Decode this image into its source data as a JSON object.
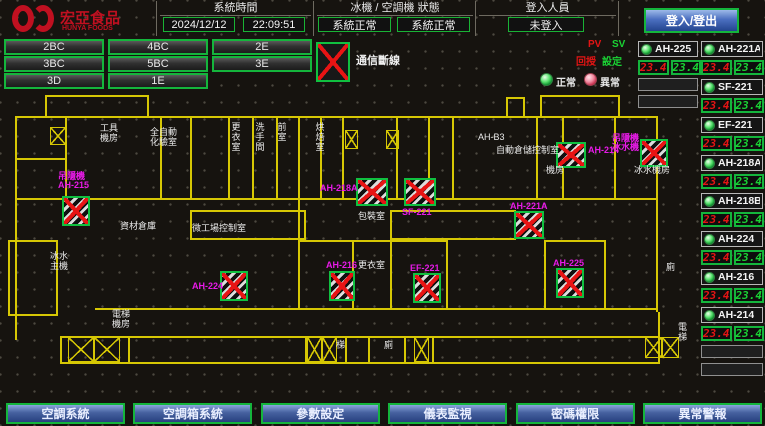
{
  "header": {
    "logo_text": "宏亞食品",
    "logo_subtext": "HUNYA FOODS",
    "time_label": "系統時間",
    "date": "2024/12/12",
    "clock": "22:09:51",
    "status_label": "冰機 / 空調機 狀態",
    "chiller_status": "系統正常",
    "ahu_status": "系統正常",
    "login_label": "登入人員",
    "login_value": "未登入",
    "login_button": "登入/登出"
  },
  "floor_nav": {
    "rows": [
      [
        "2BC",
        "4BC",
        "2E"
      ],
      [
        "3BC",
        "5BC",
        "3E"
      ],
      [
        "3D",
        "1E"
      ]
    ]
  },
  "legend": {
    "comm_loss": "通信斷線",
    "pv": "PV",
    "sv": "SV",
    "pv_sub": "回授",
    "sv_sub": "設定",
    "normal": "正常",
    "abnormal": "異常"
  },
  "units_panel": {
    "left_column": [
      {
        "name": "AH-225",
        "pv": "23.4",
        "sv": "23.4"
      }
    ],
    "right_column": [
      {
        "name": "AH-221A",
        "pv": "23.4",
        "sv": "23.4"
      },
      {
        "name": "SF-221",
        "pv": "23.4",
        "sv": "23.4"
      },
      {
        "name": "EF-221",
        "pv": "23.4",
        "sv": "23.4"
      },
      {
        "name": "AH-218A",
        "pv": "23.4",
        "sv": "23.4"
      },
      {
        "name": "AH-218B",
        "pv": "23.4",
        "sv": "23.4"
      },
      {
        "name": "AH-224",
        "pv": "23.4",
        "sv": "23.4"
      },
      {
        "name": "AH-216",
        "pv": "23.4",
        "sv": "23.4"
      },
      {
        "name": "AH-214",
        "pv": "23.4",
        "sv": "23.4"
      }
    ]
  },
  "map": {
    "walls": [
      [
        15,
        116,
        643,
        2
      ],
      [
        45,
        95,
        104,
        2
      ],
      [
        45,
        95,
        2,
        23
      ],
      [
        147,
        95,
        2,
        23
      ],
      [
        540,
        95,
        80,
        2
      ],
      [
        540,
        95,
        2,
        23
      ],
      [
        618,
        95,
        2,
        23
      ],
      [
        506,
        97,
        19,
        2
      ],
      [
        506,
        97,
        2,
        21
      ],
      [
        523,
        97,
        2,
        21
      ],
      [
        15,
        116,
        2,
        224
      ],
      [
        65,
        116,
        2,
        84
      ],
      [
        15,
        158,
        52,
        2
      ],
      [
        160,
        116,
        2,
        84
      ],
      [
        190,
        116,
        2,
        84
      ],
      [
        228,
        116,
        2,
        84
      ],
      [
        252,
        116,
        2,
        84
      ],
      [
        276,
        116,
        2,
        84
      ],
      [
        298,
        116,
        2,
        84
      ],
      [
        320,
        116,
        2,
        84
      ],
      [
        342,
        116,
        2,
        84
      ],
      [
        396,
        116,
        2,
        84
      ],
      [
        428,
        116,
        2,
        84
      ],
      [
        452,
        116,
        2,
        84
      ],
      [
        536,
        116,
        2,
        84
      ],
      [
        562,
        116,
        2,
        84
      ],
      [
        614,
        116,
        2,
        84
      ],
      [
        656,
        116,
        2,
        196
      ],
      [
        15,
        198,
        643,
        2
      ],
      [
        190,
        210,
        116,
        2
      ],
      [
        190,
        238,
        116,
        2
      ],
      [
        190,
        210,
        2,
        30
      ],
      [
        304,
        210,
        2,
        30
      ],
      [
        390,
        210,
        126,
        2
      ],
      [
        390,
        238,
        126,
        2
      ],
      [
        390,
        210,
        2,
        30
      ],
      [
        514,
        210,
        2,
        30
      ],
      [
        8,
        240,
        50,
        2
      ],
      [
        8,
        314,
        50,
        2
      ],
      [
        8,
        240,
        2,
        76
      ],
      [
        56,
        240,
        2,
        76
      ],
      [
        298,
        198,
        2,
        112
      ],
      [
        298,
        240,
        150,
        2
      ],
      [
        352,
        240,
        2,
        68
      ],
      [
        390,
        240,
        2,
        68
      ],
      [
        446,
        240,
        2,
        68
      ],
      [
        544,
        240,
        62,
        2
      ],
      [
        544,
        240,
        2,
        68
      ],
      [
        604,
        240,
        2,
        68
      ],
      [
        95,
        308,
        563,
        2
      ],
      [
        60,
        336,
        600,
        2
      ],
      [
        60,
        362,
        600,
        2
      ],
      [
        60,
        336,
        2,
        28
      ],
      [
        128,
        336,
        2,
        28
      ],
      [
        305,
        336,
        2,
        28
      ],
      [
        345,
        336,
        2,
        28
      ],
      [
        368,
        336,
        2,
        28
      ],
      [
        404,
        336,
        2,
        28
      ],
      [
        432,
        336,
        2,
        28
      ],
      [
        658,
        312,
        2,
        52
      ]
    ],
    "stairs": [
      [
        50,
        127,
        16,
        18
      ],
      [
        345,
        130,
        13,
        19
      ],
      [
        386,
        130,
        13,
        19
      ],
      [
        68,
        337,
        26,
        25
      ],
      [
        94,
        337,
        26,
        25
      ],
      [
        307,
        337,
        15,
        25
      ],
      [
        322,
        337,
        15,
        25
      ],
      [
        414,
        337,
        15,
        25
      ],
      [
        645,
        337,
        17,
        21
      ],
      [
        662,
        337,
        17,
        21
      ]
    ],
    "units": [
      {
        "x": 62,
        "y": 196,
        "w": 28,
        "h": 30,
        "label": "吊隱機\nAH-215",
        "lx": 58,
        "ly": 172
      },
      {
        "x": 356,
        "y": 178,
        "w": 32,
        "h": 28,
        "label": "AH-218A",
        "lx": 320,
        "ly": 184
      },
      {
        "x": 404,
        "y": 178,
        "w": 32,
        "h": 28,
        "label": "SF-221",
        "lx": 402,
        "ly": 208
      },
      {
        "x": 556,
        "y": 142,
        "w": 30,
        "h": 26,
        "label": "AH-214",
        "lx": 588,
        "ly": 146
      },
      {
        "x": 640,
        "y": 139,
        "w": 28,
        "h": 28,
        "label": "吊隱機\n冰水機",
        "lx": 612,
        "ly": 134
      },
      {
        "x": 514,
        "y": 211,
        "w": 30,
        "h": 28,
        "label": "AH-221A",
        "lx": 510,
        "ly": 202
      },
      {
        "x": 220,
        "y": 271,
        "w": 28,
        "h": 30,
        "label": "AH-224",
        "lx": 192,
        "ly": 282
      },
      {
        "x": 329,
        "y": 271,
        "w": 26,
        "h": 30,
        "label": "AH-216",
        "lx": 326,
        "ly": 261
      },
      {
        "x": 413,
        "y": 273,
        "w": 28,
        "h": 30,
        "label": "EF-221",
        "lx": 410,
        "ly": 264
      },
      {
        "x": 556,
        "y": 268,
        "w": 28,
        "h": 30,
        "label": "AH-225",
        "lx": 553,
        "ly": 259
      }
    ],
    "labels": [
      {
        "x": 100,
        "y": 124,
        "text": "工具\n機房"
      },
      {
        "x": 150,
        "y": 128,
        "text": "全自動\n化驗室"
      },
      {
        "x": 120,
        "y": 222,
        "text": "資材倉庫"
      },
      {
        "x": 192,
        "y": 224,
        "text": "微工場控制室"
      },
      {
        "x": 50,
        "y": 252,
        "text": "冰水\n主機"
      },
      {
        "x": 496,
        "y": 146,
        "text": "自動倉儲控制室"
      },
      {
        "x": 478,
        "y": 133,
        "text": "AH-B3"
      },
      {
        "x": 358,
        "y": 261,
        "text": "更衣室"
      },
      {
        "x": 358,
        "y": 212,
        "text": "包裝室"
      },
      {
        "x": 112,
        "y": 310,
        "text": "電梯\n機房"
      },
      {
        "x": 336,
        "y": 341,
        "text": "梯"
      },
      {
        "x": 384,
        "y": 341,
        "text": "廁"
      },
      {
        "x": 666,
        "y": 263,
        "text": "廁"
      },
      {
        "x": 678,
        "y": 323,
        "text": "電\n梯"
      },
      {
        "x": 546,
        "y": 166,
        "text": "機房"
      },
      {
        "x": 634,
        "y": 166,
        "text": "冰水機房"
      },
      {
        "x": 230,
        "y": 122,
        "text": "更衣室",
        "vert": true
      },
      {
        "x": 254,
        "y": 122,
        "text": "洗手間",
        "vert": true
      },
      {
        "x": 276,
        "y": 122,
        "text": "前室",
        "vert": true
      },
      {
        "x": 314,
        "y": 122,
        "text": "烘焙室",
        "vert": true
      }
    ]
  },
  "bottom_nav": {
    "items": [
      "空調系統",
      "空調箱系統",
      "參數設定",
      "儀表監視",
      "密碼權限",
      "異常警報"
    ]
  },
  "colors": {
    "wall_yellow": "#d6c704",
    "ok_green": "#14b53c",
    "alarm_red": "#e81414",
    "unit_magenta": "#e81ae8",
    "nav_blue": "#46619f",
    "logo_red": "#c01020"
  }
}
